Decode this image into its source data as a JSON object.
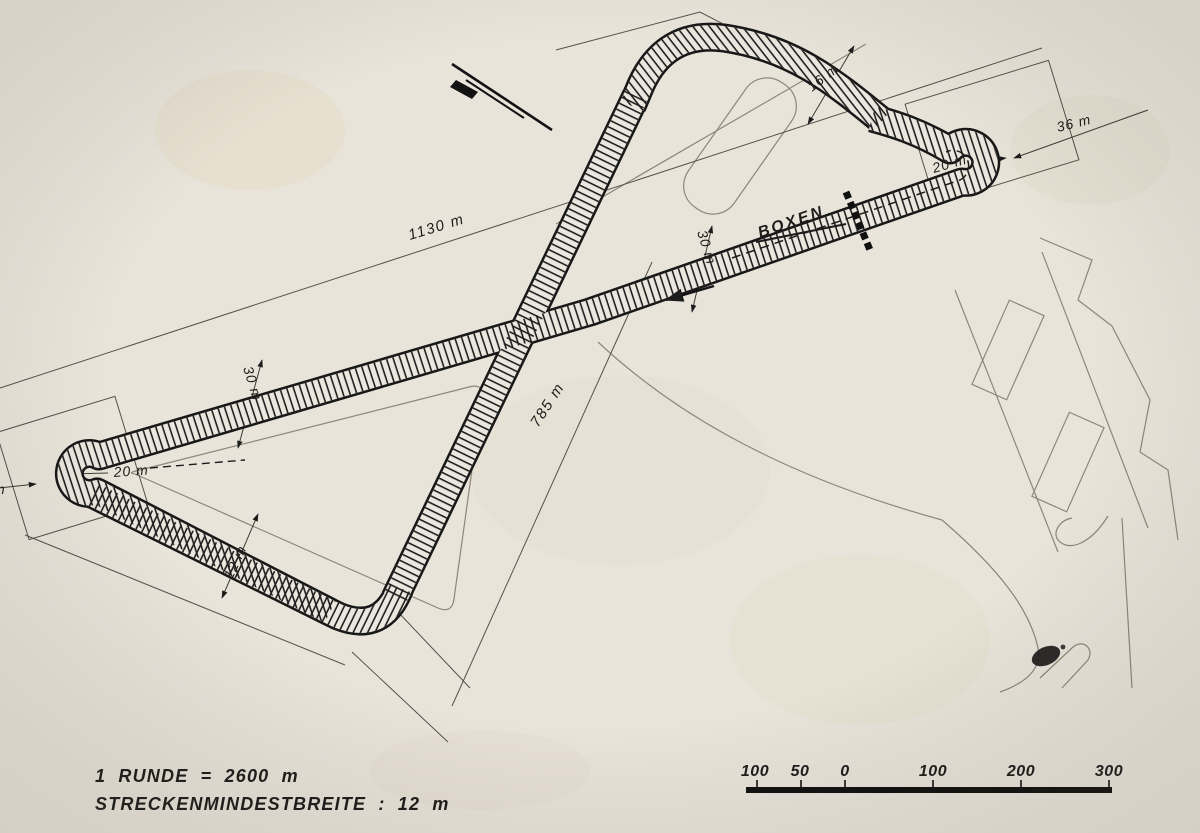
{
  "labels": {
    "boxen": "BOXEN",
    "dim_1130": "1130 m",
    "dim_785": "785 m",
    "dim_30_upper": "30 m",
    "dim_30_center": "30 m",
    "dim_16": "16 m",
    "dim_36": "36 m",
    "dim_20_right": "20 m",
    "dim_20_left": "20 m",
    "dim_12": "12 m",
    "dim_left_edge_partial": "m"
  },
  "footer": {
    "lap_length": "1 RUNDE = 2600 m",
    "min_track_width": "STRECKENMINDESTBREITE : 12 m"
  },
  "scale_bar": {
    "ticks": [
      "100",
      "50",
      "0",
      "100",
      "200",
      "300"
    ]
  },
  "colors": {
    "paper": "#e9e4da",
    "ink": "#1c1c1c",
    "thin_line": "#55514a",
    "background_line": "#8d8779"
  }
}
